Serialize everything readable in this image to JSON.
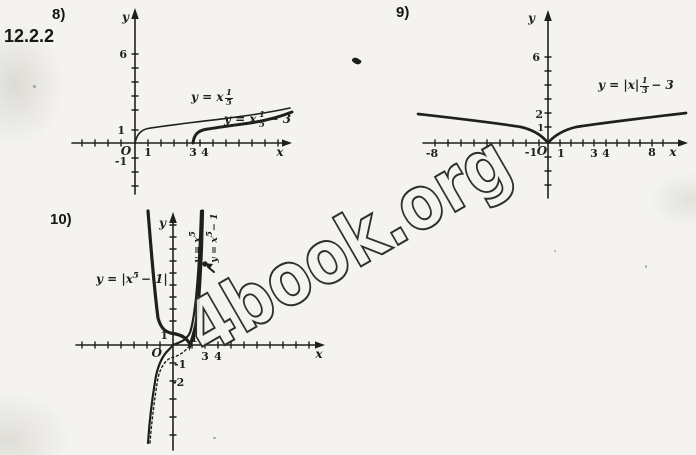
{
  "page": {
    "section_number": "12.2.2",
    "watermark_text": "4book.org",
    "ink_color": "#1f1f1f",
    "paper_color": "#f4f3ef"
  },
  "graph8": {
    "problem_label": "8)",
    "y_axis_label": "y",
    "x_axis_label": "x",
    "origin_label": "O",
    "y_tick_labels": [
      "6",
      "1",
      "-1"
    ],
    "x_tick_labels": [
      "1",
      "3",
      "4"
    ],
    "curve_thin_label": {
      "prefix": "y = x",
      "frac_num": "1",
      "frac_den": "5",
      "suffix": ""
    },
    "curve_thick_label": {
      "prefix": "y = x",
      "frac_num": "1",
      "frac_den": "5",
      "suffix": "− 3"
    }
  },
  "graph9": {
    "problem_label": "9)",
    "y_axis_label": "y",
    "x_axis_label": "x",
    "origin_label": "O",
    "y_tick_labels": [
      "6",
      "2",
      "1"
    ],
    "x_tick_labels": [
      "-8",
      "-1",
      "1",
      "3",
      "4",
      "8"
    ],
    "curve_label": {
      "prefix": "y = |x|",
      "frac_num": "1",
      "frac_den": "3",
      "suffix": "− 3"
    }
  },
  "graph10": {
    "problem_label": "10)",
    "y_axis_label": "y",
    "x_axis_label": "x",
    "origin_label": "O",
    "y_tick_labels": [
      "1",
      "-1",
      "-2"
    ],
    "x_tick_labels": [
      "1",
      "3",
      "4"
    ],
    "curve_main_label": {
      "prefix": "y = |x",
      "sup": "5",
      "suffix": "− 1|"
    },
    "curve_v1_label": {
      "prefix": "y = x",
      "sup": "5",
      "suffix": ""
    },
    "curve_v2_label": {
      "prefix": "y = x",
      "sup": "5",
      "suffix": "− 1"
    }
  },
  "chart_data": [
    {
      "id": "8",
      "type": "line",
      "title": "",
      "xlabel": "x",
      "ylabel": "y",
      "x_tick_labels": [
        1,
        3,
        4
      ],
      "y_tick_labels": [
        6,
        1,
        -1
      ],
      "xlim": [
        -4.5,
        11
      ],
      "ylim": [
        -2.5,
        8
      ],
      "grid": false,
      "series": [
        {
          "name": "y = x^(1/5)",
          "style": "thin solid",
          "points": [
            [
              0,
              0
            ],
            [
              1,
              1
            ],
            [
              4,
              1.32
            ],
            [
              8,
              1.52
            ],
            [
              11,
              1.62
            ]
          ]
        },
        {
          "name": "y = x^(1/5) − 3",
          "style": "thick solid, drawn shifted right starting at x=3",
          "points": [
            [
              3,
              0
            ],
            [
              4,
              1
            ],
            [
              7,
              1.32
            ],
            [
              11,
              1.52
            ]
          ]
        }
      ]
    },
    {
      "id": "9",
      "type": "line",
      "title": "",
      "xlabel": "x",
      "ylabel": "y",
      "x_tick_labels": [
        -8,
        -1,
        1,
        3,
        4,
        8
      ],
      "y_tick_labels": [
        6,
        2,
        1
      ],
      "xlim": [
        -10,
        11
      ],
      "ylim": [
        -4,
        9
      ],
      "grid": false,
      "series": [
        {
          "name": "y = |x|^(1/3) − 3",
          "style": "thick solid, V-shaped cusp at origin",
          "points": [
            [
              -8,
              2
            ],
            [
              -1,
              1
            ],
            [
              0,
              0
            ],
            [
              1,
              1
            ],
            [
              8,
              2
            ]
          ]
        }
      ]
    },
    {
      "id": "10",
      "type": "line",
      "title": "",
      "xlabel": "x",
      "ylabel": "y",
      "x_tick_labels": [
        1,
        3,
        4
      ],
      "y_tick_labels": [
        1,
        -1,
        -2
      ],
      "xlim": [
        -7.5,
        11
      ],
      "ylim": [
        -9,
        11
      ],
      "grid": false,
      "series": [
        {
          "name": "y = |x⁵ − 1|",
          "style": "thick solid",
          "points": [
            [
              -1.4,
              6.4
            ],
            [
              -1,
              2
            ],
            [
              0,
              1
            ],
            [
              1,
              0
            ],
            [
              1.2,
              1.5
            ],
            [
              1.4,
              4.4
            ]
          ]
        },
        {
          "name": "y = x⁵",
          "style": "thin solid",
          "points": [
            [
              -1.4,
              -5.4
            ],
            [
              -1,
              -1
            ],
            [
              0,
              0
            ],
            [
              1,
              1
            ],
            [
              1.4,
              5.4
            ]
          ]
        },
        {
          "name": "y = x⁵ − 1",
          "style": "dotted",
          "points": [
            [
              -1.4,
              -6.4
            ],
            [
              -1,
              -2
            ],
            [
              0,
              -1
            ],
            [
              1,
              0
            ],
            [
              1.4,
              4.4
            ]
          ]
        }
      ],
      "annotations": [
        {
          "type": "marked-point-with-arrow",
          "near": "steep right branch above x = 1"
        }
      ]
    }
  ]
}
